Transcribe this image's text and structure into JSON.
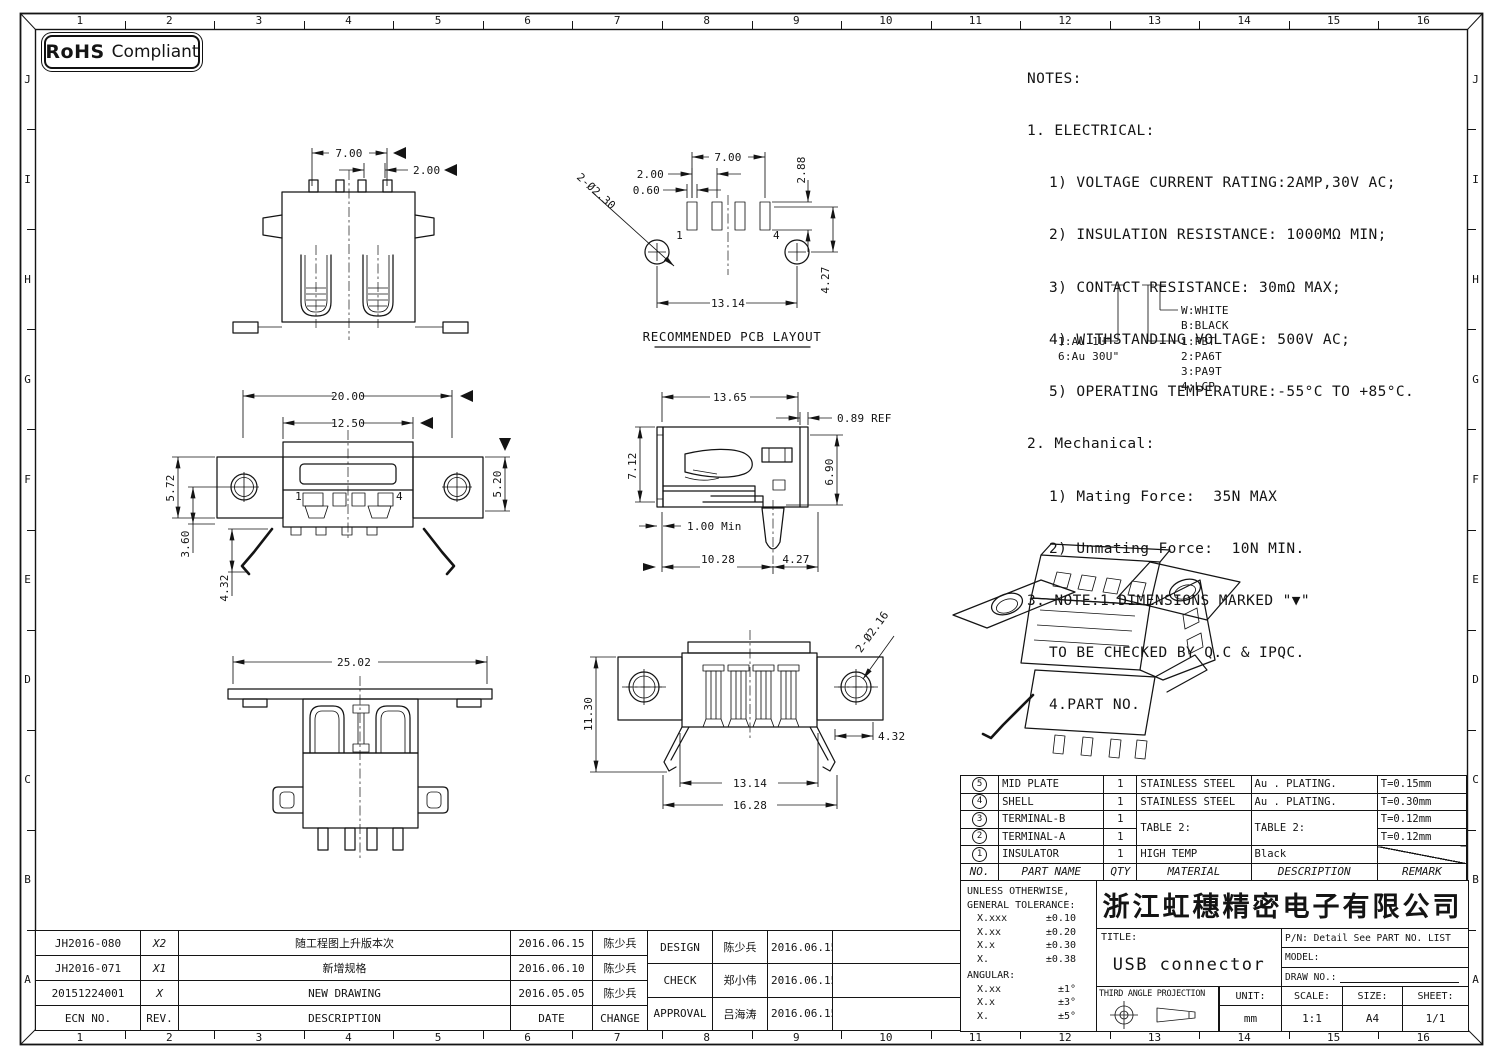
{
  "badge": {
    "rohs": "RoHS",
    "compliant": "Compliant"
  },
  "border": {
    "columns": [
      "1",
      "2",
      "3",
      "4",
      "5",
      "6",
      "7",
      "8",
      "9",
      "10",
      "11",
      "12",
      "13",
      "14",
      "15",
      "16"
    ],
    "rows": [
      "J",
      "I",
      "H",
      "G",
      "F",
      "E",
      "D",
      "C",
      "B",
      "A"
    ]
  },
  "notes": {
    "lines": [
      "NOTES:",
      "1. ELECTRICAL:",
      "1) VOLTAGE CURRENT RATING:2AMP,30V AC;",
      "2) INSULATION RESISTANCE: 1000MΩ MIN;",
      "3) CONTACT RESISTANCE: 30mΩ MAX;",
      "4) WITHSTANDING VOLTAGE: 500V AC;",
      "5) OPERATING TEMPERATURE:-55°C TO +85°C.",
      "2. Mechanical:",
      "1) Mating Force:  35N MAX",
      "2) Unmating Force:  10N MIN.",
      "3. NOTE:1.DIMENSIONS MARKED \"▼\"",
      "TO BE CHECKED BY Q.C & IPQC.",
      "4.PART NO."
    ]
  },
  "legend": {
    "au1": "1:Au 1U\"",
    "au6": "6:Au 30U\"",
    "w": "W:WHITE",
    "b": "B:BLACK",
    "p1": "1:PBT",
    "p2": "2:PA6T",
    "p3": "3:PA9T",
    "p4": "4:LCP"
  },
  "views": {
    "front_top": {
      "d_700": "7.00",
      "d_200": "2.00"
    },
    "pcb": {
      "caption": "RECOMMENDED PCB LAYOUT",
      "d_700": "7.00",
      "d_200": "2.00",
      "d_060": "0.60",
      "d_288": "2.88",
      "d_427": "4.27",
      "d_1314": "13.14",
      "d_hole": "2-Ø2.30",
      "pin1": "1",
      "pin4": "4"
    },
    "front_mid": {
      "d_2000": "20.00",
      "d_1250": "12.50",
      "d_572": "5.72",
      "d_520": "5.20",
      "d_360": "3.60",
      "d_432": "4.32",
      "pin1": "1",
      "pin4": "4"
    },
    "side": {
      "d_1365": "13.65",
      "d_089": "0.89 REF",
      "d_712": "7.12",
      "d_690": "6.90",
      "d_100": "1.00 Min",
      "d_1028": "10.28",
      "d_427": "4.27"
    },
    "rear": {
      "d_2502": "25.02"
    },
    "top": {
      "d_1130": "11.30",
      "d_hole": "2-Ø2.16",
      "d_432": "4.32",
      "d_1314": "13.14",
      "d_1628": "16.28"
    }
  },
  "bom": {
    "headers": {
      "no": "NO.",
      "part": "PART NAME",
      "qty": "QTY",
      "material": "MATERIAL",
      "description": "DESCRIPTION",
      "remark": "REMARK"
    },
    "rows": [
      {
        "no": "5",
        "part": "MID PLATE",
        "qty": "1",
        "material": "STAINLESS STEEL",
        "description": "Au . PLATING.",
        "remark": "T=0.15mm"
      },
      {
        "no": "4",
        "part": "SHELL",
        "qty": "1",
        "material": "STAINLESS STEEL",
        "description": "Au . PLATING.",
        "remark": "T=0.30mm"
      },
      {
        "no": "3",
        "part": "TERMINAL-B",
        "qty": "1",
        "material": "TABLE 2:",
        "description": "TABLE 2:",
        "remark": "T=0.12mm"
      },
      {
        "no": "2",
        "part": "TERMINAL-A",
        "qty": "1",
        "material": "",
        "description": "",
        "remark": "T=0.12mm"
      },
      {
        "no": "1",
        "part": "INSULATOR",
        "qty": "1",
        "material": "HIGH TEMP",
        "description": "Black",
        "remark": ""
      }
    ]
  },
  "tolerance": {
    "l1": "UNLESS OTHERWISE,",
    "l2": "GENERAL TOLERANCE:",
    "rows": [
      {
        "k": "X.xxx",
        "v": "±0.10"
      },
      {
        "k": "X.xx",
        "v": "±0.20"
      },
      {
        "k": "X.x",
        "v": "±0.30"
      },
      {
        "k": "X.",
        "v": "±0.38"
      }
    ],
    "angular": "ANGULAR:",
    "arows": [
      {
        "k": "X.xx",
        "v": "±1°"
      },
      {
        "k": "X.x",
        "v": "±3°"
      },
      {
        "k": "X.",
        "v": "±5°"
      }
    ]
  },
  "title_block": {
    "company": "浙江虹穗精密电子有限公司",
    "title_label": "TITLE:",
    "title": "USB connector",
    "pn": "P/N: Detail See PART NO. LIST",
    "model_label": "MODEL:",
    "draw_label": "DRAW NO.:",
    "projection": "THIRD ANGLE PROJECTION",
    "unit_label": "UNIT:",
    "unit": "mm",
    "scale_label": "SCALE:",
    "scale": "1:1",
    "size_label": "SIZE:",
    "size": "A4",
    "sheet_label": "SHEET:",
    "sheet": "1/1"
  },
  "revisions": {
    "headers": {
      "ecn": "ECN NO.",
      "rev": "REV.",
      "description": "DESCRIPTION",
      "date": "DATE",
      "change": "CHANGE"
    },
    "rows": [
      {
        "ecn": "JH2016-080",
        "rev": "X2",
        "description": "随工程图上升版本次",
        "date": "2016.06.15",
        "change": "陈少兵"
      },
      {
        "ecn": "JH2016-071",
        "rev": "X1",
        "description": "新增规格",
        "date": "2016.06.10",
        "change": "陈少兵"
      },
      {
        "ecn": "20151224001",
        "rev": "X",
        "description": "NEW DRAWING",
        "date": "2016.05.05",
        "change": "陈少兵"
      }
    ]
  },
  "approvals": {
    "rows": [
      {
        "role": "DESIGN",
        "name": "陈少兵",
        "date": "2016.06.15"
      },
      {
        "role": "CHECK",
        "name": "郑小伟",
        "date": "2016.06.15"
      },
      {
        "role": "APPROVAL",
        "name": "吕海涛",
        "date": "2016.06.15"
      }
    ]
  }
}
